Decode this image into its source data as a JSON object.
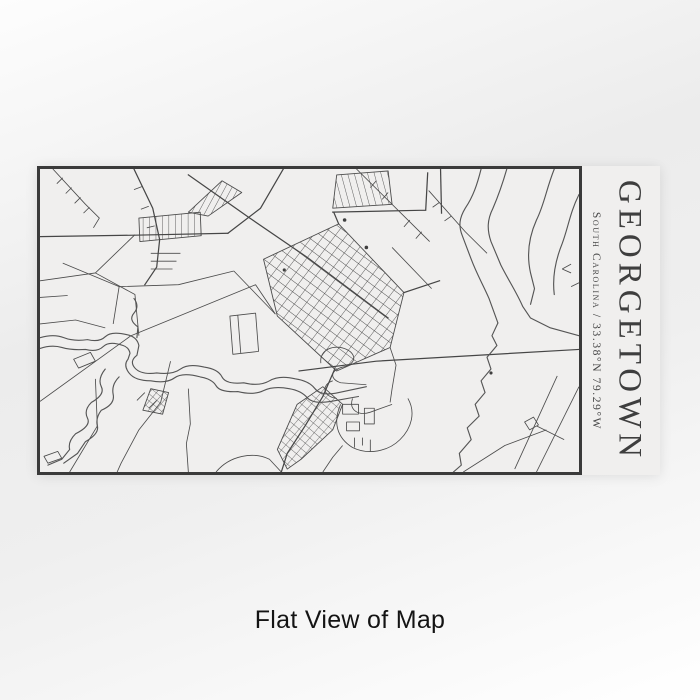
{
  "mockup": {
    "caption": "Flat View of Map"
  },
  "card": {
    "title": "Georgetown",
    "subtitle": "South Carolina / 33.38°N 79.29°W",
    "map_icon": "street-map-graphic"
  },
  "map": {
    "place": "Georgetown",
    "region": "South Carolina",
    "coordinates": "33.38°N 79.29°W"
  },
  "colors": {
    "map_background": "#f0efee",
    "map_border": "#3a3a3a",
    "road": "#4b4b4b",
    "water_line": "#555555",
    "label_text": "#3e3e3e",
    "caption_text": "#141414"
  }
}
